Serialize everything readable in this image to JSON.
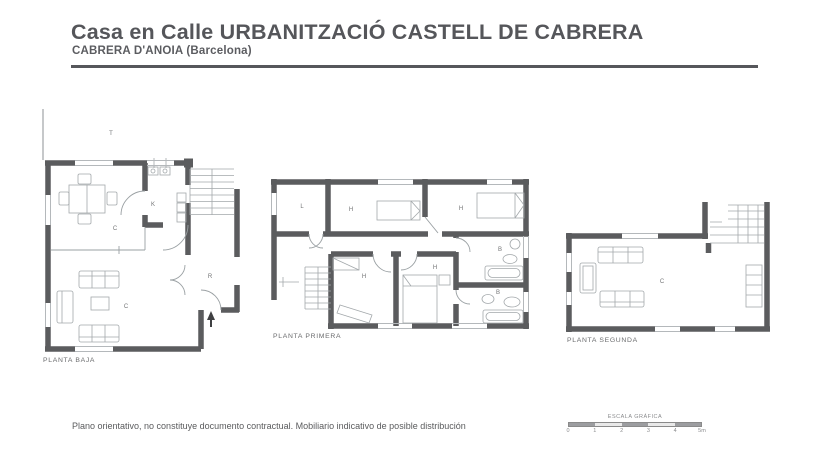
{
  "header": {
    "title": "Casa en Calle URBANITZACIÓ CASTELL DE CABRERA",
    "subtitle": "CABRERA D'ANOIA (Barcelona)"
  },
  "plans": [
    {
      "caption": "PLANTA BAJA",
      "rooms": [
        {
          "label": "T"
        },
        {
          "label": "C"
        },
        {
          "label": "K"
        },
        {
          "label": "C"
        },
        {
          "label": "R"
        }
      ]
    },
    {
      "caption": "PLANTA PRIMERA",
      "rooms": [
        {
          "label": "L"
        },
        {
          "label": "H"
        },
        {
          "label": "H"
        },
        {
          "label": "B"
        },
        {
          "label": "H"
        },
        {
          "label": "H"
        },
        {
          "label": "B"
        }
      ]
    },
    {
      "caption": "PLANTA SEGUNDA",
      "rooms": [
        {
          "label": "C"
        }
      ]
    }
  ],
  "footer": {
    "disclaimer": "Plano orientativo, no constituye documento contractual. Mobiliario indicativo de posible distribución",
    "scale_label": "ESCALA GRÁFICA",
    "scale_ticks": [
      "0",
      "1",
      "2",
      "3",
      "4",
      "5m"
    ]
  },
  "colors": {
    "wall": "#5b5c5e",
    "furniture_line": "#a3a8ab",
    "text": "#55565a",
    "room_label": "#737476"
  }
}
